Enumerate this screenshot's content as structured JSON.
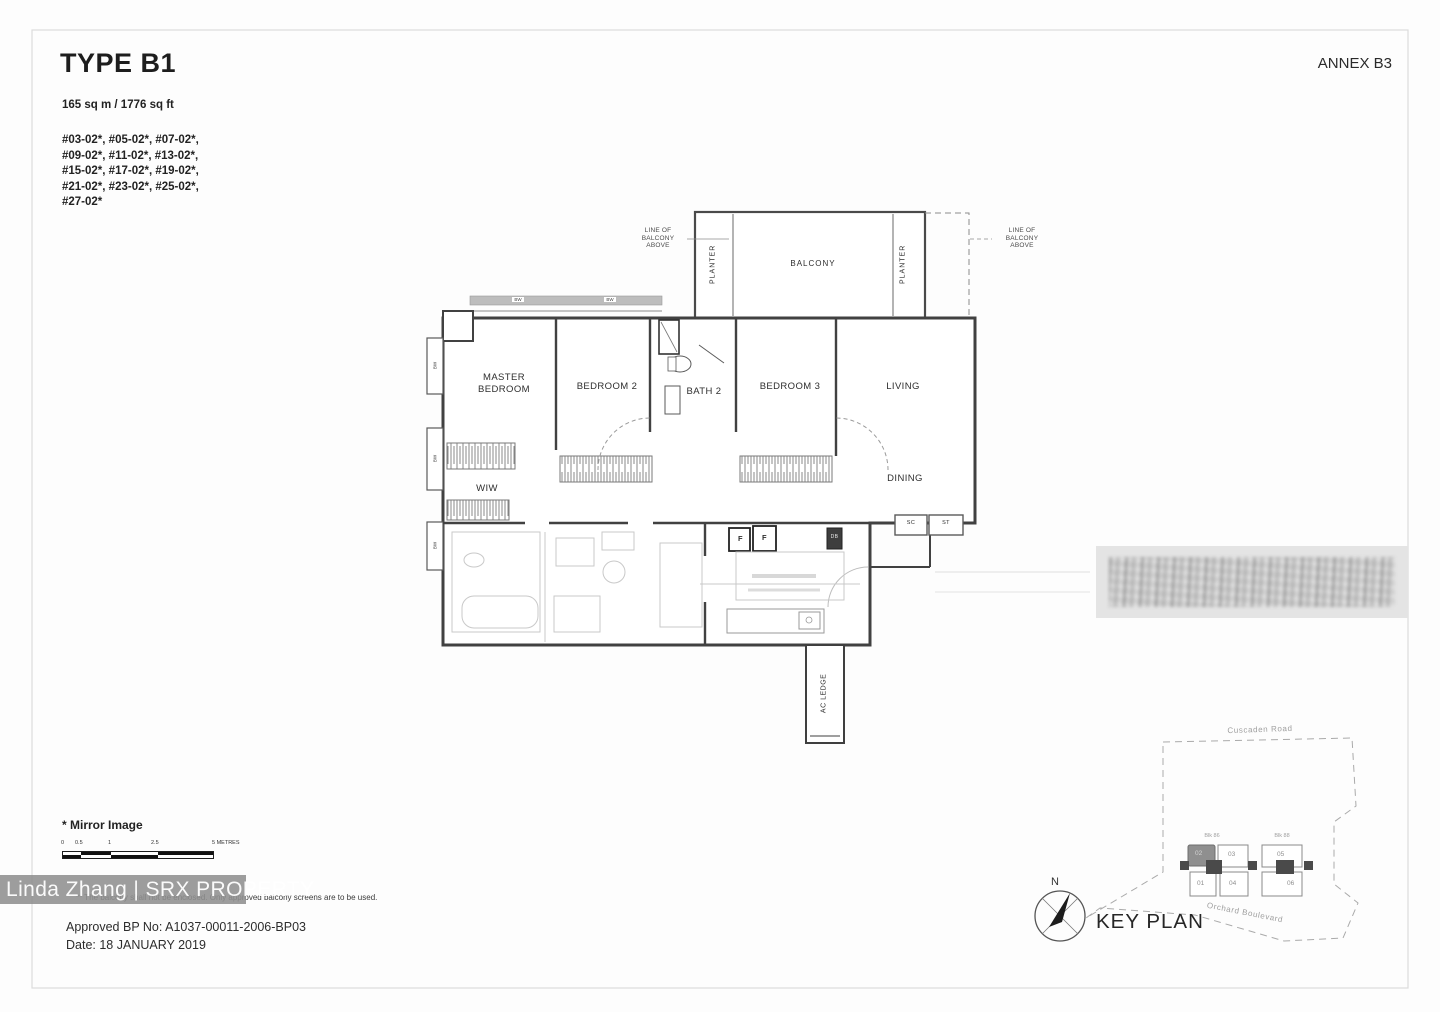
{
  "page": {
    "title": "TYPE B1",
    "annex": "ANNEX B3",
    "area": "165 sq m / 1776 sq ft",
    "unit_list": [
      "#03-02*, #05-02*, #07-02*,",
      "#09-02*, #11-02*, #13-02*,",
      "#15-02*, #17-02*, #19-02*,",
      "#21-02*, #23-02*, #25-02*,",
      "#27-02*"
    ]
  },
  "plan": {
    "balcony": "BALCONY",
    "planter_left": "PLANTER",
    "planter_right": "PLANTER",
    "lob_left": "LINE OF\nBALCONY\nABOVE",
    "lob_right": "LINE OF\nBALCONY\nABOVE",
    "master_bedroom": "MASTER\nBEDROOM",
    "bedroom2": "BEDROOM 2",
    "bath2": "BATH 2",
    "bedroom3": "BEDROOM 3",
    "living": "LIVING",
    "dining": "DINING",
    "wiw": "WIW",
    "ac_ledge": "AC LEDGE",
    "bw": "BW",
    "f": "F",
    "db": "DB",
    "sc": "SC",
    "st": "ST"
  },
  "footer": {
    "mirror_note": "* Mirror Image",
    "scale_ticks": [
      "0",
      "0.5",
      "1",
      "2.5"
    ],
    "scale_unit": "5 METRES",
    "balcony_note": "** The balcony shall not be enclosed. Only approved balcony screens are to be used.",
    "approved_bp": "Approved BP No: A1037-00011-2006-BP03",
    "date": "Date: 18 JANUARY 2019"
  },
  "watermark": {
    "text": "Linda Zhang | SRX PROPERTY"
  },
  "keyplan": {
    "title": "KEY PLAN",
    "north": "N",
    "road_top": "Cuscaden Road",
    "road_bottom": "Orchard Boulevard",
    "blk_left": "Blk 86",
    "blk_right": "Blk 88",
    "u01": "01",
    "u02": "02",
    "u03": "03",
    "u04": "04",
    "u05": "05",
    "u06": "06"
  },
  "colors": {
    "wall": "#414141",
    "ghost": "#c9c9c9",
    "watermark_bg": "#8f8f8f",
    "highlight_unit": "#8f8f8f"
  }
}
